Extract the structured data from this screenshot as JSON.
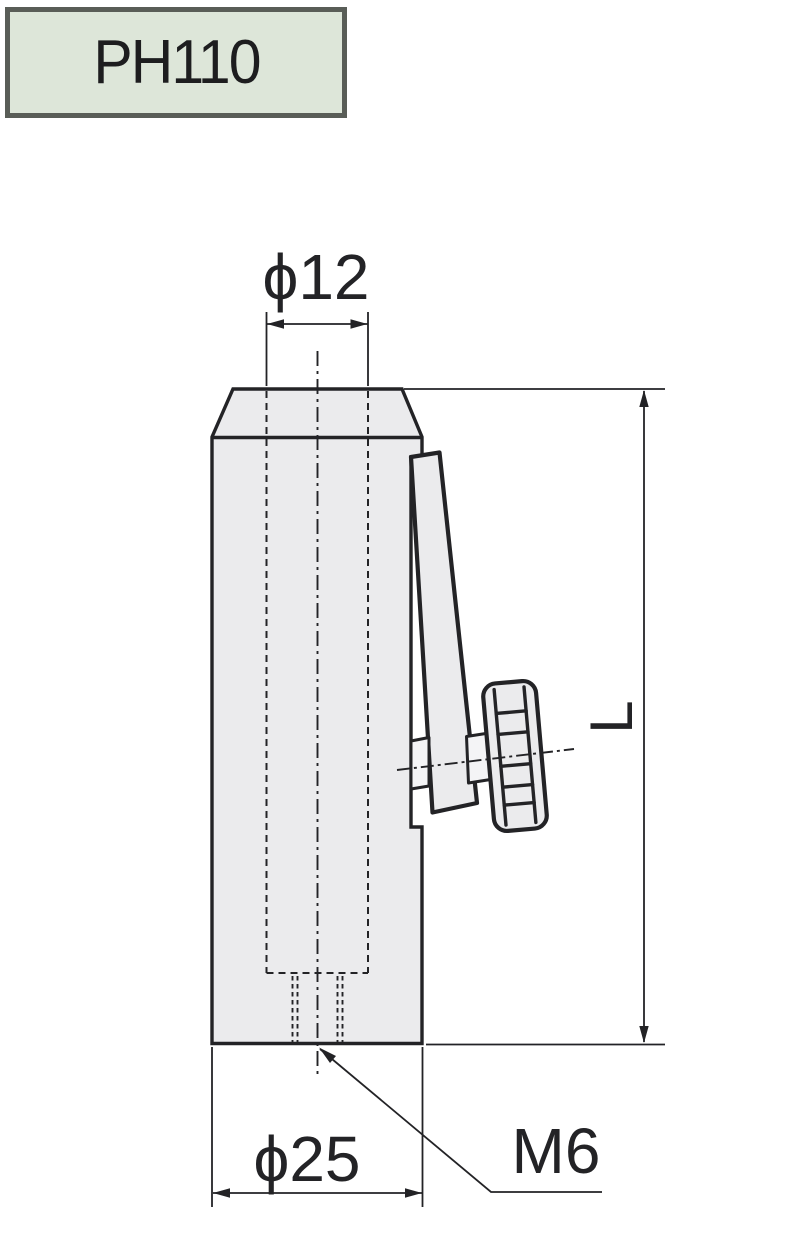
{
  "title_badge": {
    "label": "PH110"
  },
  "drawing": {
    "labels": {
      "top_diameter": "ϕ12",
      "bottom_diameter": "ϕ25",
      "thread": "M6",
      "length": "L"
    },
    "colors": {
      "line": "#232326",
      "body_fill": "#ebebed",
      "gap_fill": "#f4f4f6",
      "badge_fill": "#dde6d9",
      "badge_border": "#595d57",
      "background": "#ffffff"
    }
  }
}
